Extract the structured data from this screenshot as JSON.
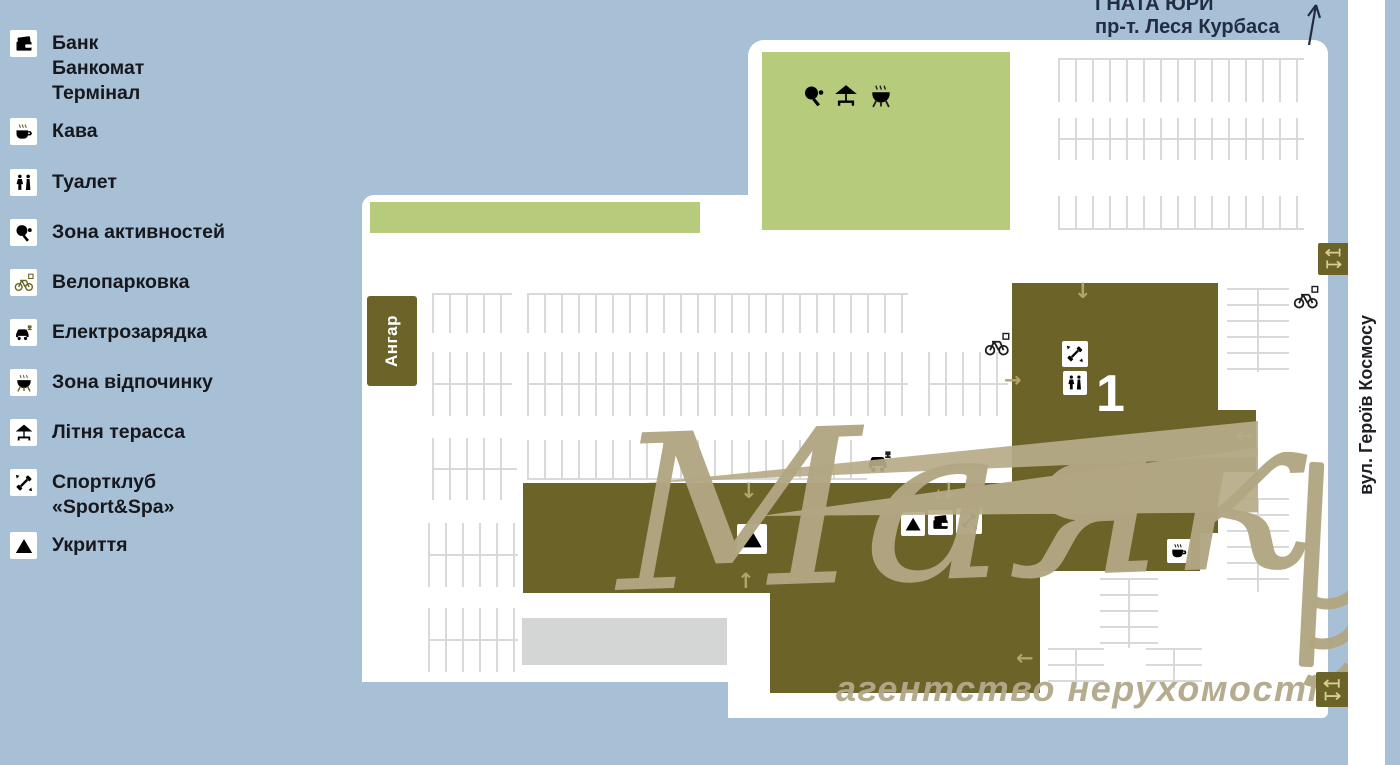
{
  "colors": {
    "background": "#a7c0d6",
    "map_white": "#ffffff",
    "green_zone": "#b7cb7d",
    "building_olive": "#6b6328",
    "arrow_tan": "#b3a56a",
    "watermark_beige": "#b4a782",
    "road_gray": "#d3d6d5",
    "legend_text": "#16181d",
    "header_navy": "#232d42"
  },
  "header": {
    "street_line1": "ГНАТА ЮРИ",
    "street_line2": "пр-т. Леся Курбаса"
  },
  "streets": {
    "right_vertical": "вул. Героїв Космосу"
  },
  "legend": {
    "items": [
      {
        "id": "bank",
        "label": "Банк\nБанкомат\nТермінал",
        "icon": "bank-card-icon"
      },
      {
        "id": "coffee",
        "label": "Кава",
        "icon": "coffee-icon"
      },
      {
        "id": "wc",
        "label": "Туалет",
        "icon": "wc-icon"
      },
      {
        "id": "activity",
        "label": "Зона активностей",
        "icon": "table-tennis-icon"
      },
      {
        "id": "bike",
        "label": "Велопарковка",
        "icon": "bike-parking-icon"
      },
      {
        "id": "ev",
        "label": "Електрозарядка",
        "icon": "ev-charging-icon"
      },
      {
        "id": "rest",
        "label": "Зона відпочинку",
        "icon": "bbq-grill-icon"
      },
      {
        "id": "terrace",
        "label": "Літня терасса",
        "icon": "terrace-umbrella-icon"
      },
      {
        "id": "sport",
        "label": "Спортклуб\n«Sport&Spa»",
        "icon": "dumbbell-icon"
      },
      {
        "id": "shelter",
        "label": "Укриття",
        "icon": "shelter-triangle-icon"
      }
    ]
  },
  "map": {
    "hangar_label": "Ангар",
    "building_number": "1"
  },
  "watermark": {
    "brand": "Маяк",
    "tagline": "агентство нерухомості"
  }
}
